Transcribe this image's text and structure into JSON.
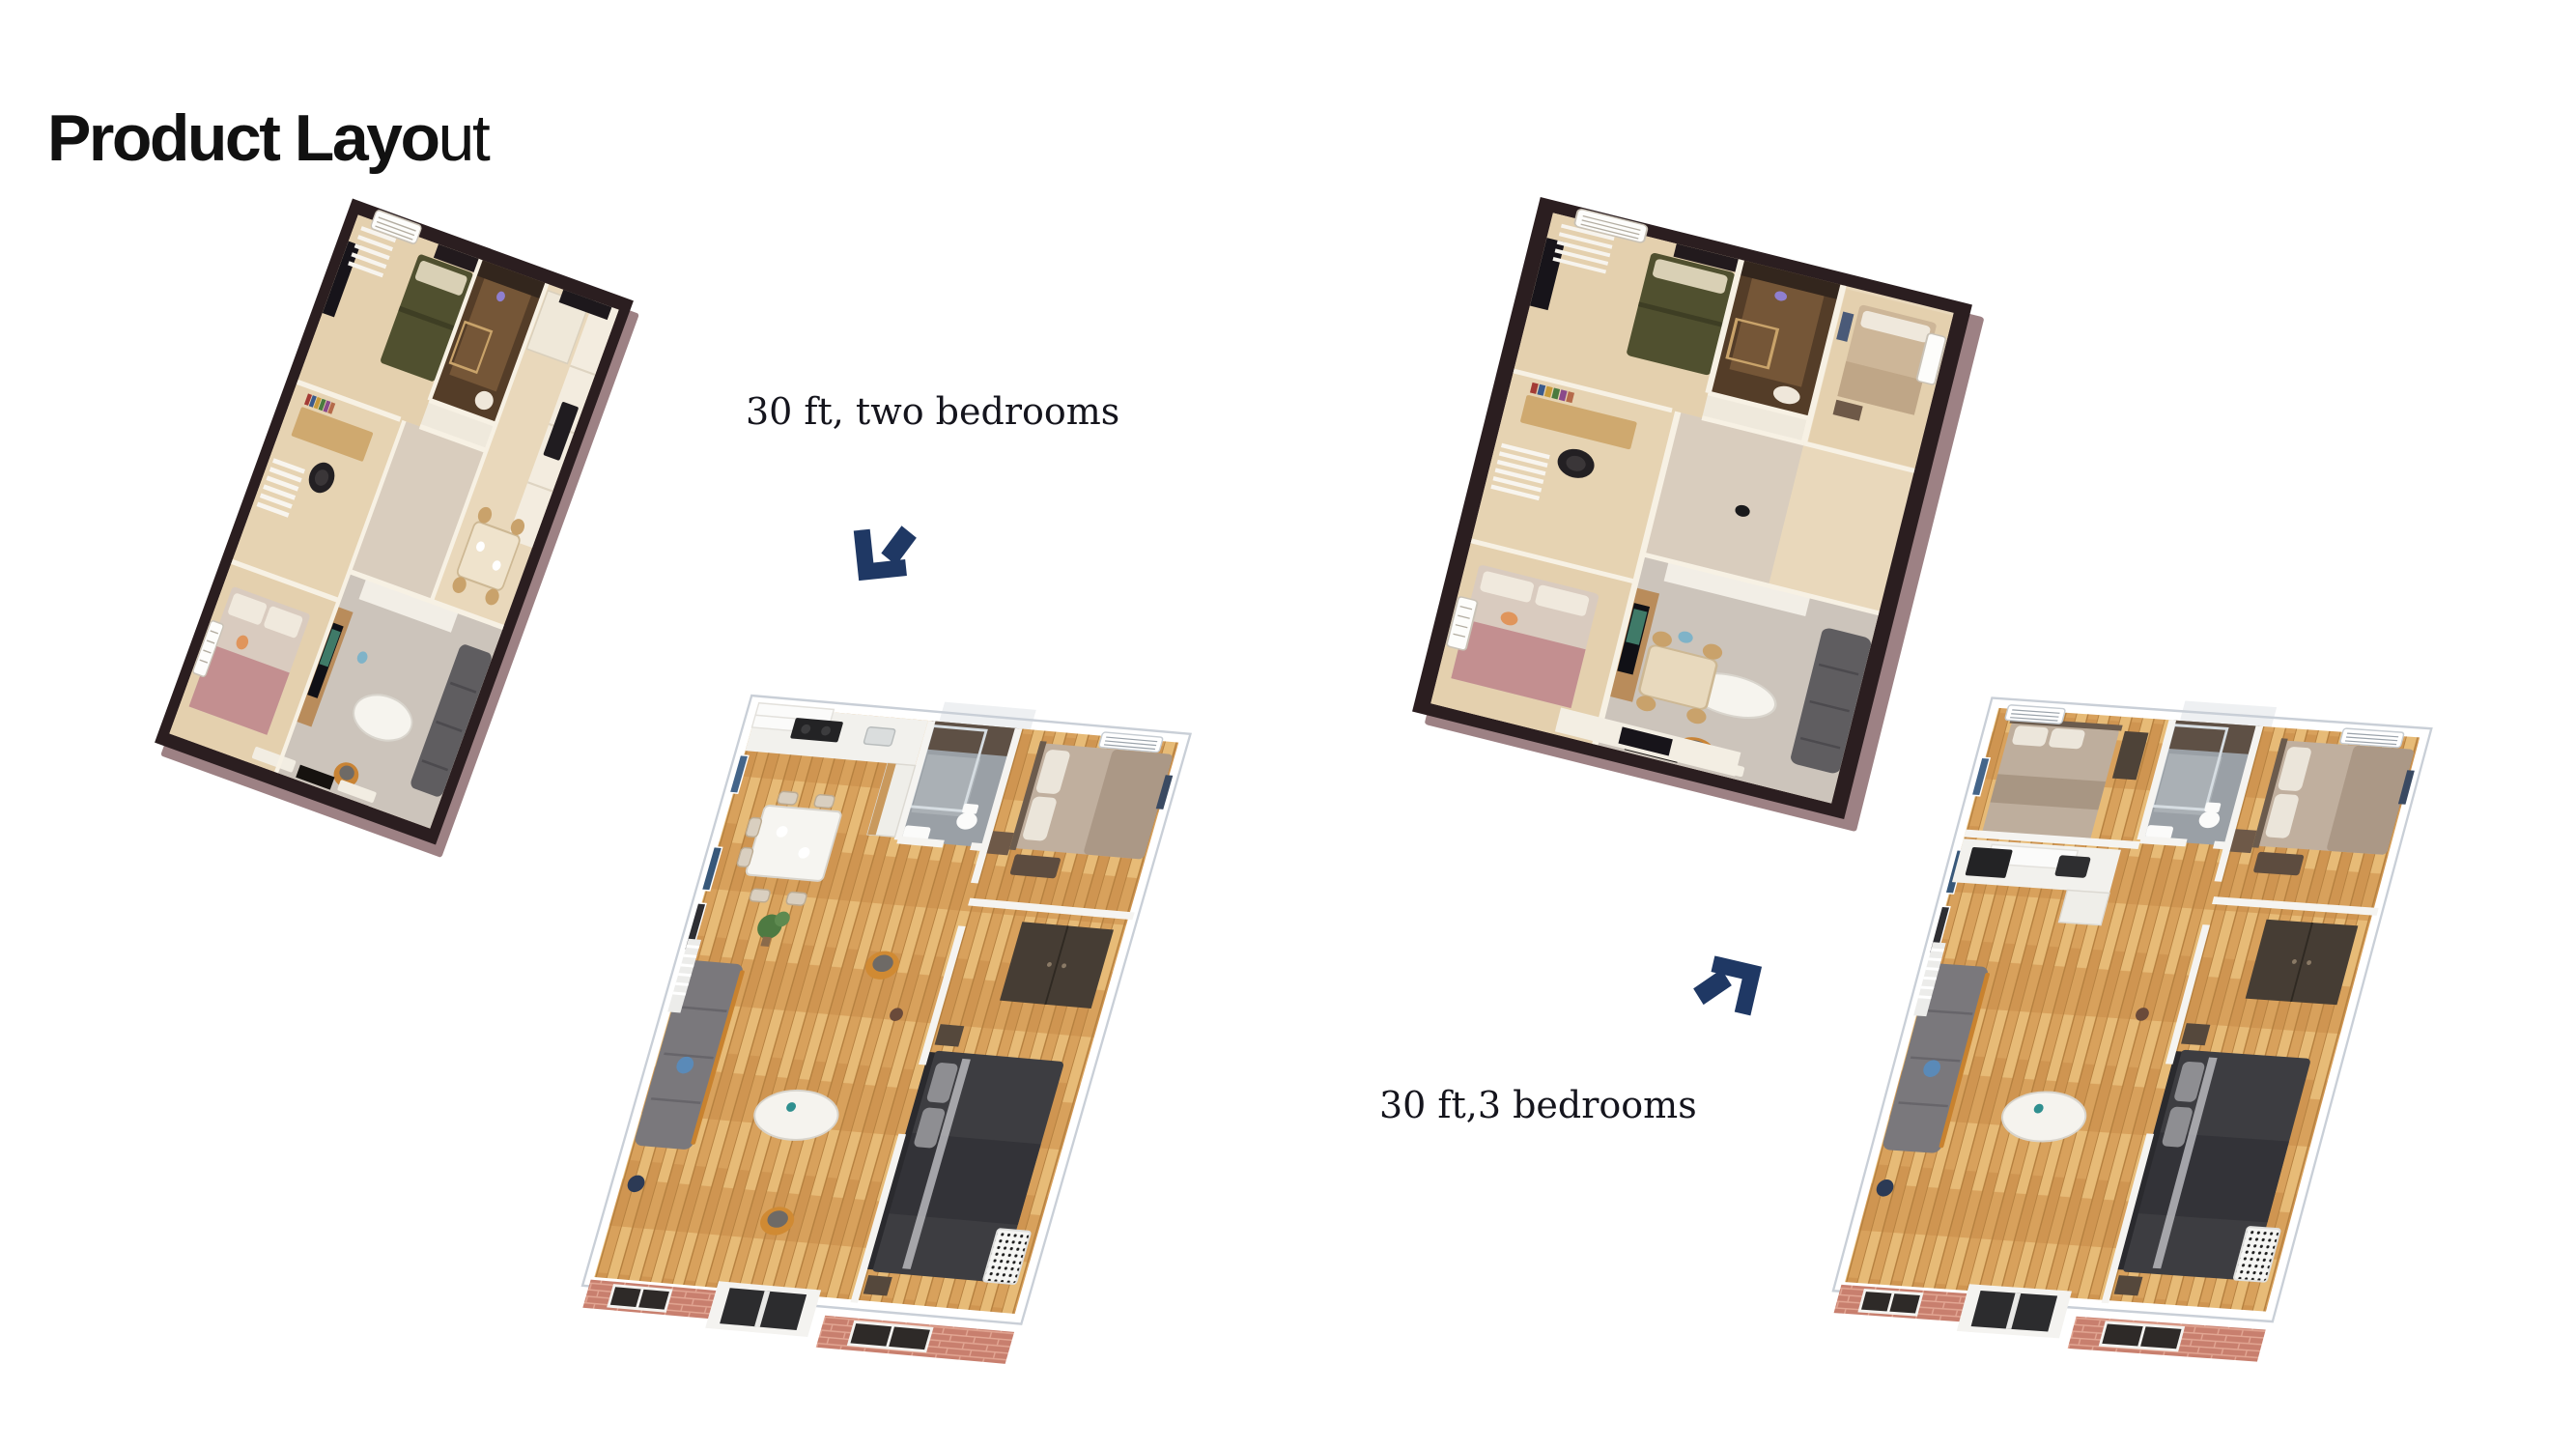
{
  "page": {
    "background": "#ffffff"
  },
  "title": {
    "text": "Product Layout",
    "bold_part": "Product Layo",
    "regular_part": "ut"
  },
  "products": [
    {
      "id": "30ft-two-bedrooms",
      "caption": "30 ft, two bedrooms",
      "arrow_icon": "arrow-down-left-icon"
    },
    {
      "id": "30ft-three-bedrooms",
      "caption": "30 ft,3 bedrooms",
      "arrow_icon": "arrow-up-right-icon"
    }
  ],
  "theme": {
    "background": "#ffffff",
    "title-color": "#111111",
    "caption-color": "#15151d",
    "arrow-navy": "#1f3864",
    "frame-dark": "#2b1e20",
    "frame-bevel": "#9d8184",
    "wall-cream": "#e9d8bb",
    "floor-gray": "#ccc4bb",
    "bed-green": "#50502f",
    "wood-floor": "#d9a360",
    "brick-salmon": "#c87f6e",
    "wall-white": "#f4f3f0",
    "sofa-gray": "#7a787c",
    "bed-dark": "#3d3d41",
    "bed-tan": "#c0af9e",
    "chair-orange": "#d08a33",
    "tile-gray": "#9aa0a6"
  }
}
